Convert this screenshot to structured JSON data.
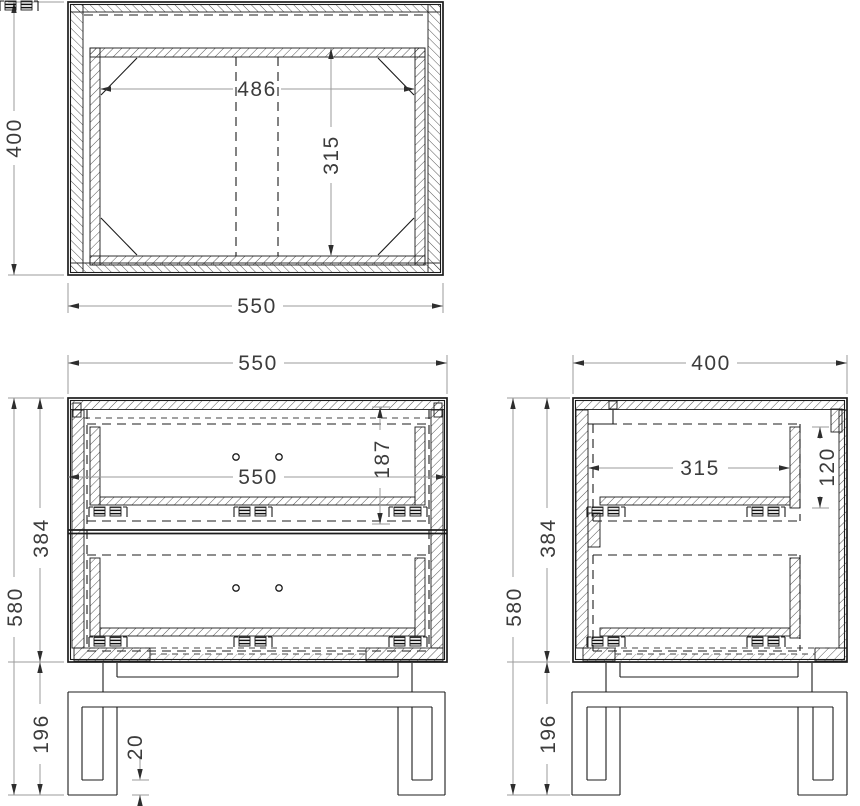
{
  "drawing": {
    "type": "furniture-orthographic-technical-drawing",
    "views": {
      "top": {
        "label_depth": "400",
        "label_width": "550",
        "label_inner_width": "486",
        "label_inner_depth": "315"
      },
      "front": {
        "label_width": "550",
        "label_inner_width": "550",
        "label_drawer_height": "187",
        "label_carcass_height": "384",
        "label_total_height": "580",
        "label_base_height": "196",
        "label_foot_thickness": "20"
      },
      "side": {
        "label_depth": "400",
        "label_inner_depth": "315",
        "label_drawer_inner_height": "120",
        "label_carcass_height": "384",
        "label_total_height": "580",
        "label_base_height": "196"
      }
    }
  }
}
